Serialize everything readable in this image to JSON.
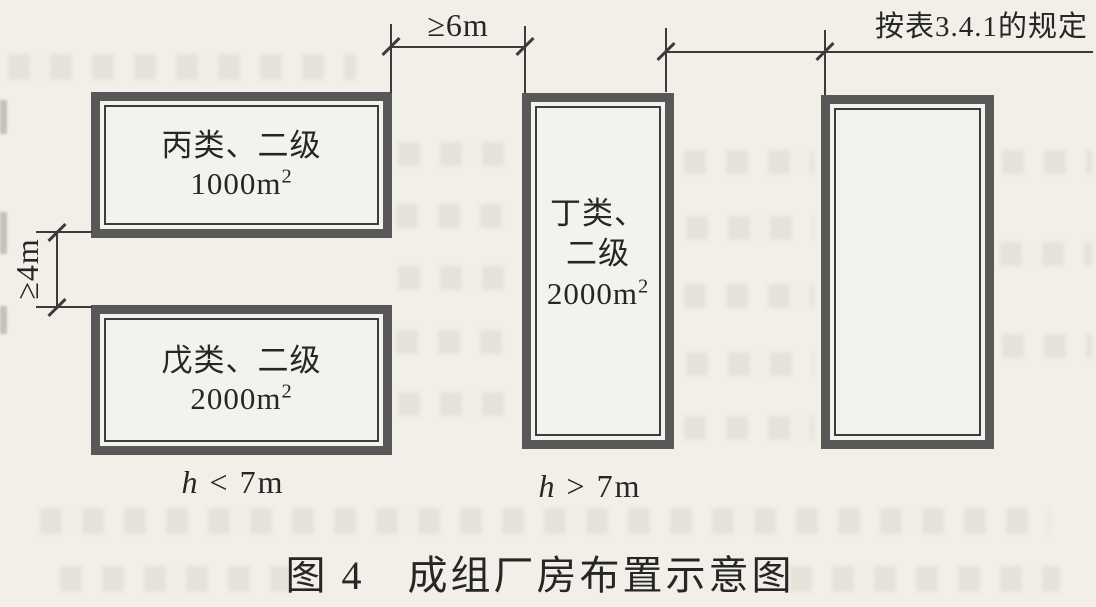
{
  "figure": {
    "caption": "图 4　成组厂房布置示意图",
    "dimensions": {
      "top_gap_label": "≥6m",
      "left_gap_label": "≥4m",
      "right_rule_label": "按表3.4.1的规定"
    },
    "buildings": {
      "top_left": {
        "category": "丙类、二级",
        "area": "1000m",
        "area_exp": "2"
      },
      "bottom_left": {
        "category": "戊类、二级",
        "area": "2000m",
        "area_exp": "2"
      },
      "middle": {
        "category_line1": "丁类、",
        "category_line2": "二级",
        "area": "2000m",
        "area_exp": "2"
      }
    },
    "height_labels": {
      "left": {
        "variable": "h",
        "relation": " < 7m"
      },
      "middle": {
        "variable": "h",
        "relation": " > 7m"
      }
    }
  }
}
